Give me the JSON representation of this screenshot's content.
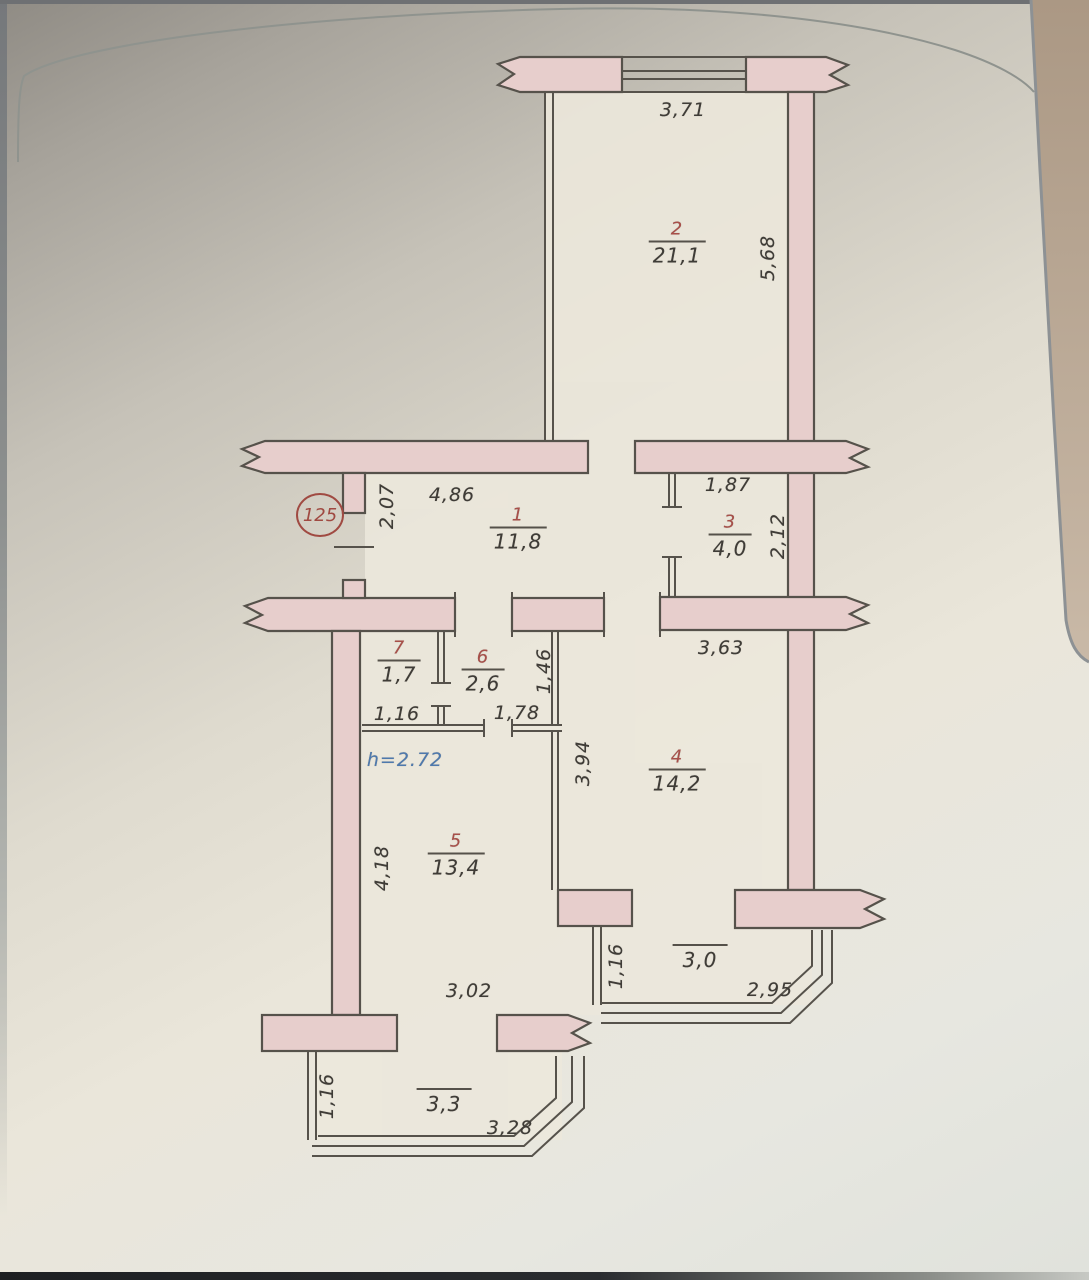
{
  "page": {
    "apartment_badge": "125",
    "ceiling_height_note": "h=2.72",
    "rooms": {
      "r1": {
        "number": "1",
        "area": "11,8"
      },
      "r2": {
        "number": "2",
        "area": "21,1"
      },
      "r3": {
        "number": "3",
        "area": "4,0"
      },
      "r4": {
        "number": "4",
        "area": "14,2"
      },
      "r5": {
        "number": "5",
        "area": "13,4"
      },
      "r6": {
        "number": "6",
        "area": "2,6"
      },
      "r7": {
        "number": "7",
        "area": "1,7"
      }
    },
    "balconies": {
      "left": {
        "area": "3,3"
      },
      "right": {
        "area": "3,0"
      }
    },
    "dims": {
      "room2_width": "3,71",
      "room2_depth": "5,68",
      "hall_entry_side": "2,07",
      "hall_width": "4,86",
      "room3_width": "1,87",
      "room3_depth": "2,12",
      "room4_width": "3,63",
      "room7_width": "1,16",
      "room6_width": "1,78",
      "room6_right_side": "1,46",
      "room4_left_side": "3,94",
      "room5_left_side": "4,18",
      "room5_width": "3,02",
      "balcony_right_side": "1,16",
      "balcony_right_width": "2,95",
      "balcony_left_side": "1,16",
      "balcony_left_width": "3,28"
    }
  }
}
